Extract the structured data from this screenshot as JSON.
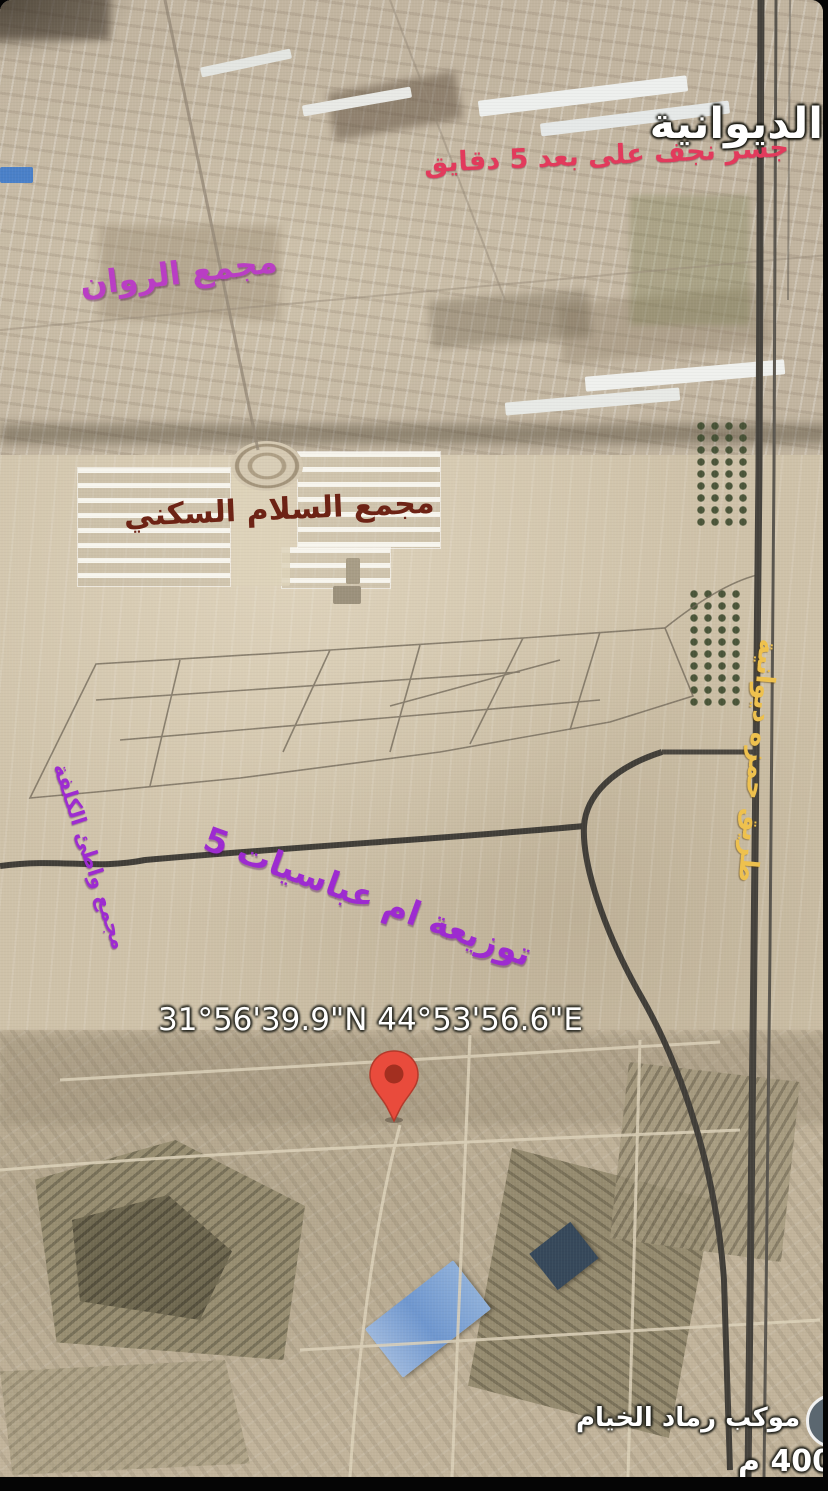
{
  "map": {
    "labels": {
      "city": "الديوانية",
      "bridge_note": "جسر نجف على بعد 5 دقايق",
      "rawan_complex": "مجمع الروان",
      "salam_complex": "مجمع السلام السكني",
      "lowcost_complex": "مجمع واطئ الكلفة",
      "abbasiyat": "توزيعة ام عباسيات 5",
      "hamza_road": "طريق حمزه ديوانية",
      "coordinates": "31°56'39.9\"N 44°53'56.6\"E",
      "mawkib": "موكب رماد الخيام",
      "distance": "400 م"
    },
    "icons": {
      "pin": "red-map-pin",
      "sticker": "circle-sticker"
    },
    "colors": {
      "city_label": "#ffffff",
      "bridge_note": "#e23a5c",
      "rawan_label": "#b93ec4",
      "salam_label": "#6d2315",
      "purple_labels": "#9d2bd0",
      "road_label": "#eec14e",
      "pin_red": "#e94335",
      "terrain": "#cbbda6"
    }
  }
}
